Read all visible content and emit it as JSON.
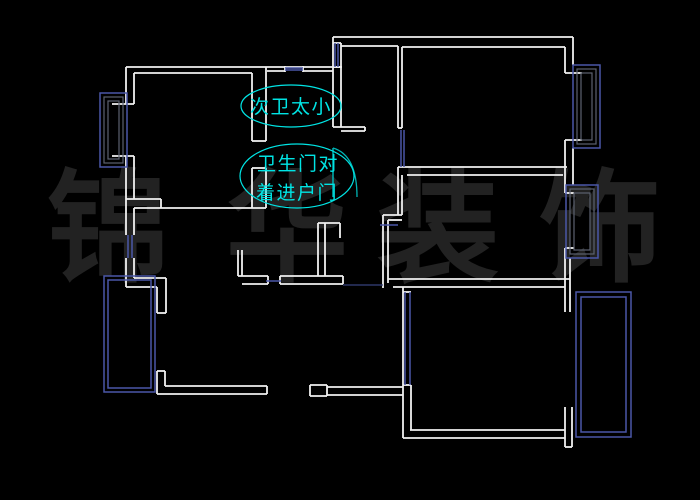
{
  "canvas": {
    "width": 700,
    "height": 500,
    "background": "#000000"
  },
  "colors": {
    "wall": "#f0f0f0",
    "window_blue": "#4a57a8",
    "dim_blue": "#36427e",
    "frame_gray": "#5c6270",
    "annotation_cyan": "#00e4e4",
    "door_teal": "#00b4b4",
    "watermark_gray": "#222222"
  },
  "watermark": {
    "font_size": 122,
    "chars": [
      {
        "t": "锦",
        "x": 108,
        "y": 228
      },
      {
        "t": "华",
        "x": 287,
        "y": 228
      },
      {
        "t": "装",
        "x": 438,
        "y": 228
      },
      {
        "t": "饰",
        "x": 600,
        "y": 228
      }
    ]
  },
  "annotations": {
    "font_size": 19,
    "letter_spacing": 1.5,
    "items": [
      {
        "name": "bathroom-too-small",
        "ellipse": {
          "cx": 291,
          "cy": 106,
          "rx": 50,
          "ry": 21
        },
        "lines": [
          {
            "text": "次卫太小",
            "x": 291,
            "y": 113
          }
        ]
      },
      {
        "name": "bath-door-faces-entry",
        "ellipse": {
          "cx": 297,
          "cy": 176,
          "rx": 57,
          "ry": 32
        },
        "lines": [
          {
            "text": "卫生门对",
            "x": 298,
            "y": 170
          },
          {
            "text": "着进户门",
            "x": 297,
            "y": 199
          }
        ]
      }
    ]
  },
  "plan": {
    "walls": [
      [
        126,
        67,
        342,
        67
      ],
      [
        134,
        73,
        252,
        73
      ],
      [
        267,
        71,
        285,
        71
      ],
      [
        303,
        71,
        333,
        71
      ],
      [
        126,
        67,
        126,
        104
      ],
      [
        134,
        73,
        134,
        104
      ],
      [
        112,
        104,
        134,
        104
      ],
      [
        112,
        156,
        134,
        156
      ],
      [
        126,
        156,
        126,
        199
      ],
      [
        134,
        156,
        134,
        199
      ],
      [
        126,
        199,
        161,
        199
      ],
      [
        161,
        199,
        161,
        208
      ],
      [
        134,
        208,
        266,
        208
      ],
      [
        126,
        199,
        126,
        235
      ],
      [
        134,
        208,
        134,
        235
      ],
      [
        126,
        258,
        126,
        287
      ],
      [
        134,
        258,
        134,
        278
      ],
      [
        134,
        278,
        166,
        278
      ],
      [
        166,
        278,
        166,
        313
      ],
      [
        126,
        287,
        157,
        287
      ],
      [
        157,
        287,
        157,
        313
      ],
      [
        157,
        313,
        166,
        313
      ],
      [
        252,
        73,
        252,
        141
      ],
      [
        266,
        67,
        266,
        141
      ],
      [
        252,
        141,
        266,
        141
      ],
      [
        252,
        168,
        252,
        208
      ],
      [
        266,
        168,
        266,
        208
      ],
      [
        252,
        168,
        266,
        168
      ],
      [
        285,
        66,
        285,
        72
      ],
      [
        303,
        66,
        303,
        72
      ],
      [
        333,
        37,
        333,
        127
      ],
      [
        341,
        43,
        341,
        127
      ],
      [
        333,
        43,
        341,
        43
      ],
      [
        333,
        67,
        341,
        67
      ],
      [
        333,
        127,
        365,
        127
      ],
      [
        341,
        131,
        365,
        131
      ],
      [
        365,
        127,
        365,
        131
      ],
      [
        333,
        37,
        573,
        37
      ],
      [
        341,
        46,
        398,
        46
      ],
      [
        402,
        47,
        565,
        47
      ],
      [
        398,
        46,
        398,
        128
      ],
      [
        402,
        47,
        402,
        128
      ],
      [
        398,
        128,
        402,
        128
      ],
      [
        398,
        167,
        567,
        167
      ],
      [
        407,
        175,
        563,
        175
      ],
      [
        398,
        167,
        398,
        215
      ],
      [
        402,
        175,
        402,
        215
      ],
      [
        383,
        215,
        402,
        215
      ],
      [
        388,
        220,
        402,
        220
      ],
      [
        383,
        215,
        383,
        288
      ],
      [
        388,
        220,
        388,
        283
      ],
      [
        573,
        37,
        573,
        65
      ],
      [
        565,
        47,
        565,
        73
      ],
      [
        565,
        73,
        582,
        73
      ],
      [
        565,
        140,
        582,
        140
      ],
      [
        565,
        140,
        565,
        193
      ],
      [
        573,
        148,
        573,
        185
      ],
      [
        565,
        193,
        574,
        193
      ],
      [
        565,
        248,
        574,
        248
      ],
      [
        565,
        248,
        565,
        312
      ],
      [
        570,
        258,
        570,
        312
      ],
      [
        388,
        279,
        570,
        279
      ],
      [
        393,
        287,
        565,
        287
      ],
      [
        403,
        287,
        403,
        438
      ],
      [
        403,
        292,
        411,
        292
      ],
      [
        403,
        385,
        411,
        385
      ],
      [
        411,
        385,
        411,
        430
      ],
      [
        410,
        430,
        565,
        430
      ],
      [
        403,
        438,
        565,
        438
      ],
      [
        565,
        407,
        565,
        447
      ],
      [
        572,
        407,
        572,
        447
      ],
      [
        565,
        447,
        572,
        447
      ],
      [
        157,
        371,
        165,
        371
      ],
      [
        157,
        371,
        157,
        394
      ],
      [
        165,
        371,
        165,
        386
      ],
      [
        165,
        386,
        267,
        386
      ],
      [
        157,
        394,
        267,
        394
      ],
      [
        267,
        386,
        267,
        394
      ],
      [
        310,
        385,
        327,
        385
      ],
      [
        310,
        396,
        327,
        396
      ],
      [
        310,
        385,
        310,
        396
      ],
      [
        327,
        385,
        327,
        396
      ],
      [
        327,
        387,
        403,
        387
      ],
      [
        327,
        395,
        403,
        395
      ],
      [
        238,
        276,
        268,
        276
      ],
      [
        242,
        284,
        268,
        284
      ],
      [
        238,
        250,
        238,
        276
      ],
      [
        242,
        250,
        242,
        276
      ],
      [
        268,
        276,
        268,
        284
      ],
      [
        280,
        276,
        343,
        276
      ],
      [
        280,
        284,
        343,
        284
      ],
      [
        280,
        276,
        280,
        284
      ],
      [
        343,
        276,
        343,
        284
      ],
      [
        318,
        223,
        318,
        276
      ],
      [
        325,
        223,
        325,
        276
      ],
      [
        318,
        223,
        340,
        223
      ],
      [
        340,
        223,
        340,
        238
      ]
    ],
    "blue_lines": [
      [
        285,
        68,
        303,
        68
      ],
      [
        285,
        70,
        303,
        70
      ],
      [
        335,
        43,
        335,
        67
      ],
      [
        338,
        43,
        338,
        67
      ],
      [
        401,
        130,
        401,
        167
      ],
      [
        404,
        130,
        404,
        167
      ],
      [
        128,
        235,
        128,
        258
      ],
      [
        132,
        235,
        132,
        258
      ],
      [
        405,
        292,
        405,
        385
      ],
      [
        410,
        292,
        410,
        385
      ],
      [
        266,
        281,
        281,
        281
      ],
      [
        380,
        225,
        398,
        225
      ]
    ],
    "dim_lines": [
      [
        343,
        285,
        383,
        285
      ]
    ],
    "blue_rects": [
      [
        100,
        93,
        27,
        74
      ],
      [
        573,
        65,
        27,
        83
      ],
      [
        566,
        185,
        32,
        73
      ],
      [
        104,
        276,
        51,
        116
      ],
      [
        108,
        280,
        43,
        108
      ],
      [
        576,
        292,
        55,
        145
      ],
      [
        581,
        297,
        45,
        135
      ]
    ],
    "gray_rects": [
      [
        104,
        97,
        19,
        66
      ],
      [
        108,
        101,
        11,
        58
      ],
      [
        577,
        69,
        19,
        75
      ],
      [
        581,
        73,
        11,
        67
      ],
      [
        570,
        189,
        24,
        65
      ],
      [
        574,
        193,
        16,
        57
      ]
    ],
    "door": {
      "leaf": [
        333,
        148,
        333,
        197
      ],
      "arc_path": "M 333,148 Q 357,155 357,197"
    }
  }
}
